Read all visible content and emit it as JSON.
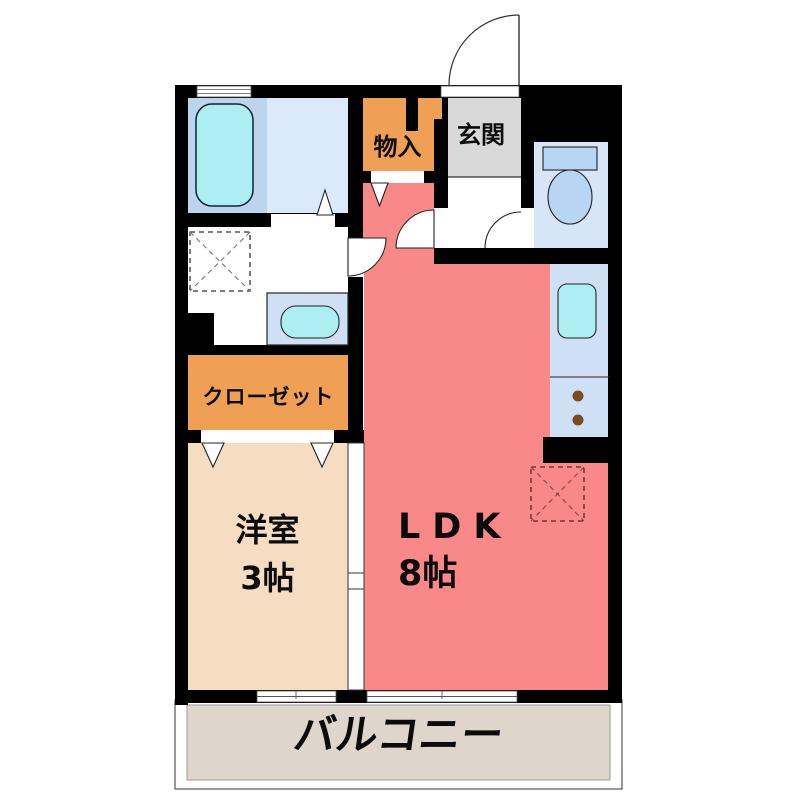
{
  "floorplan": {
    "wall_color": "#000000",
    "rooms": {
      "entrance": {
        "label": "玄関",
        "color": "#d9d9d9"
      },
      "storage": {
        "label": "物入",
        "color": "#f0a055"
      },
      "closet": {
        "label": "クローゼット",
        "color": "#f0a055"
      },
      "western_room": {
        "label": "洋室",
        "size": "3帖",
        "color": "#f6dcc0"
      },
      "ldk": {
        "label": "LDK",
        "size": "8帖",
        "color": "#f98888"
      },
      "balcony": {
        "label": "バルコニー",
        "color": "#ded6cb"
      },
      "bathroom": {
        "color": "#bdd4ee"
      },
      "dressing_room": {
        "color": "#daeafa"
      },
      "toilet_room": {
        "color": "#d6e5f7"
      },
      "kitchen": {
        "color": "#cfe0f4"
      }
    },
    "fixture_colors": {
      "tub_cyan": "#aceef2",
      "toilet_blue": "#b8d6f3",
      "basin_panel": "#cfe0f4",
      "burner_brown": "#7b4a22"
    },
    "fixtures": [
      "bathtub",
      "washing-machine-space",
      "washbasin",
      "toilet",
      "kitchen-sink",
      "stove-burners",
      "refrigerator-space"
    ]
  }
}
